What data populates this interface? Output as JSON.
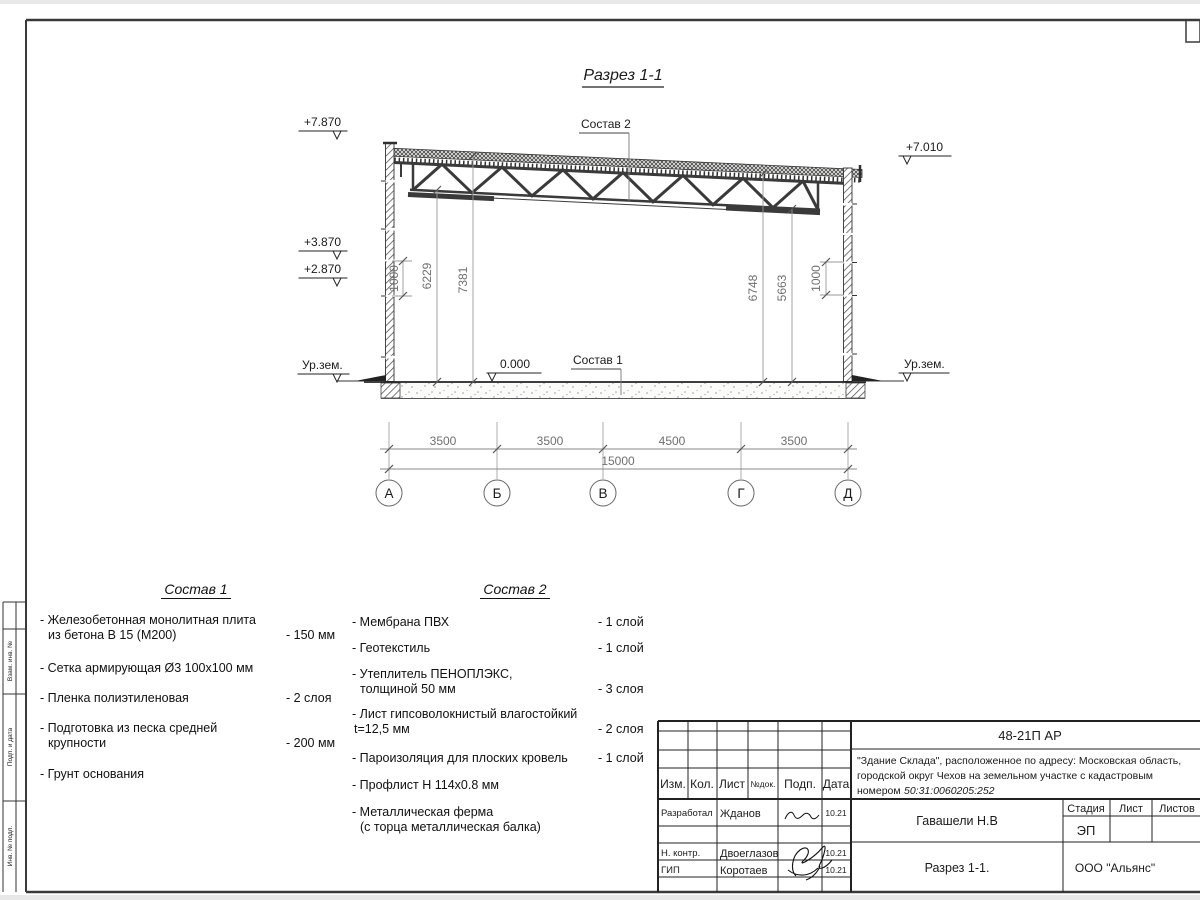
{
  "sheet": {
    "view_title": "Разрез 1-1",
    "frame_side_labels": [
      "Взам. инв. №",
      "Подп. и дата",
      "Инв. № подл."
    ]
  },
  "section": {
    "elev_roof_left": "+7.870",
    "elev_wall_left_1": "+3.870",
    "elev_wall_left_2": "+2.870",
    "elev_roof_right": "+7.010",
    "ground_label": "Ур.зем.",
    "zero_mark": "0.000",
    "ref_sostav1": "Состав 1",
    "ref_sostav2": "Состав 2",
    "vdims": {
      "left_1000": "1000",
      "h6229": "6229",
      "h7381": "7381",
      "h6748": "6748",
      "h5663": "5663",
      "right_1000": "1000"
    },
    "chain": [
      "3500",
      "3500",
      "4500",
      "3500"
    ],
    "total": "15000",
    "axes": [
      "А",
      "Б",
      "В",
      "Г",
      "Д"
    ]
  },
  "sostav1": {
    "title": "Состав 1",
    "items": [
      {
        "l1": "- Железобетонная  монолитная плита",
        "l2": "из бетона В 15 (М200)",
        "val": "- 150 мм"
      },
      {
        "l1": "- Сетка армирующая Ø3 100х100 мм",
        "l2": "",
        "val": ""
      },
      {
        "l1": "- Пленка полиэтиленовая",
        "l2": "",
        "val": "-  2 слоя"
      },
      {
        "l1": "- Подготовка из песка средней",
        "l2": "крупности",
        "val": "- 200 мм"
      },
      {
        "l1": "- Грунт основания",
        "l2": "",
        "val": ""
      }
    ]
  },
  "sostav2": {
    "title": "Состав 2",
    "items": [
      {
        "l1": "- Мембрана ПВХ",
        "l2": "",
        "val": "- 1 слой"
      },
      {
        "l1": "- Геотекстиль",
        "l2": "",
        "val": "- 1 слой"
      },
      {
        "l1": "- Утеплитель ПЕНОПЛЭКС,",
        "l2": "толщиной 50 мм",
        "val": "- 3 слоя"
      },
      {
        "l1": "- Лист гипсоволокнистый влагостойкий",
        "l2": "t=12,5 мм",
        "val": "- 2 слоя"
      },
      {
        "l1": "- Пароизоляция для плоских кровель",
        "l2": "",
        "val": "- 1 слой"
      },
      {
        "l1": "- Профлист Н 114х0.8 мм",
        "l2": "",
        "val": ""
      },
      {
        "l1": "- Металлическая ферма",
        "l2": "(с торца металлическая балка)",
        "val": ""
      }
    ]
  },
  "titleblock": {
    "doc_code": "48-21П АР",
    "object_line1": "\"Здание Склада\", расположенное по адресу: Московская область,",
    "object_line2": "городской округ Чехов на земельном участке с кадастровым",
    "object_line3_prefix": "номером ",
    "object_line3_cadastre": "50:31:0060205:252",
    "cols": {
      "izm": "Изм.",
      "kol": "Кол.",
      "list": "Лист",
      "ndok": "№док.",
      "podp": "Подп.",
      "data": "Дата"
    },
    "rows": [
      {
        "role": "Разработал",
        "name": "Жданов",
        "date": "10.21"
      },
      {
        "role": "Н. контр.",
        "name": "Двоеглазов",
        "date": "10.21"
      },
      {
        "role": "ГИП",
        "name": "Коротаев",
        "date": "10.21"
      }
    ],
    "approved_by": "Гавашели Н.В",
    "stage_cols": {
      "stage": "Стадия",
      "sheet": "Лист",
      "sheets": "Листов"
    },
    "stage_value": "ЭП",
    "sheet_name": "Разрез 1-1.",
    "organization": "ООО \"Альянс\""
  },
  "colors": {
    "line": "#2f2f2f",
    "dim_line": "#8a8a8a",
    "dim_text": "#6f6f6f",
    "paper": "#ffffff"
  }
}
